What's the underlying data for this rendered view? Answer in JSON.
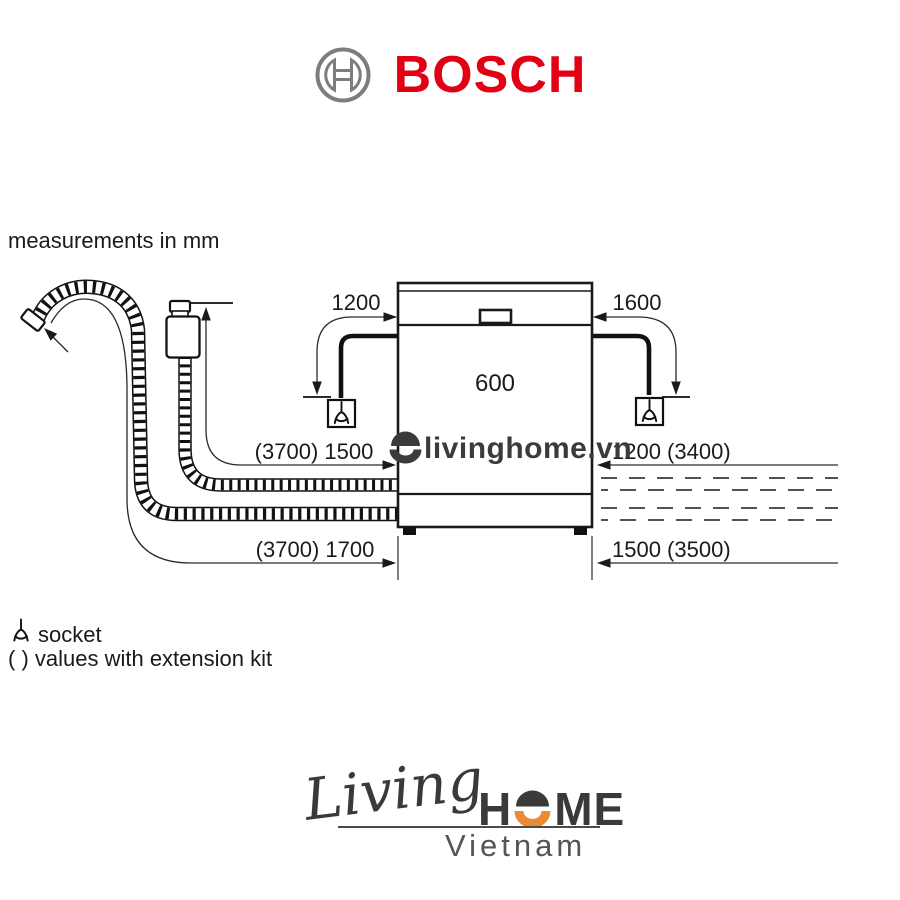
{
  "colors": {
    "bosch_red": "#e20015",
    "logo_orange": "#ec8b36",
    "ink": "#1a1a1a",
    "watermark_gray": "#3b3b3b"
  },
  "header": {
    "brand": "BOSCH"
  },
  "note": "measurements in mm",
  "diagram": {
    "dims": {
      "left_cable": "1200",
      "right_cable": "1600",
      "width": "600",
      "supply_hose": "(3700) 1500",
      "right_top": "1200 (3400)",
      "drain_hose": "(3700) 1700",
      "right_bottom": "1500 (3500)"
    }
  },
  "legend": {
    "socket_label": "socket",
    "extension_label": "( ) values with extension kit"
  },
  "watermark": {
    "text": "livinghome.vn"
  },
  "footer": {
    "living": "Living",
    "home_h": "H",
    "home_me": "ME",
    "vietnam": "Vietnam"
  }
}
